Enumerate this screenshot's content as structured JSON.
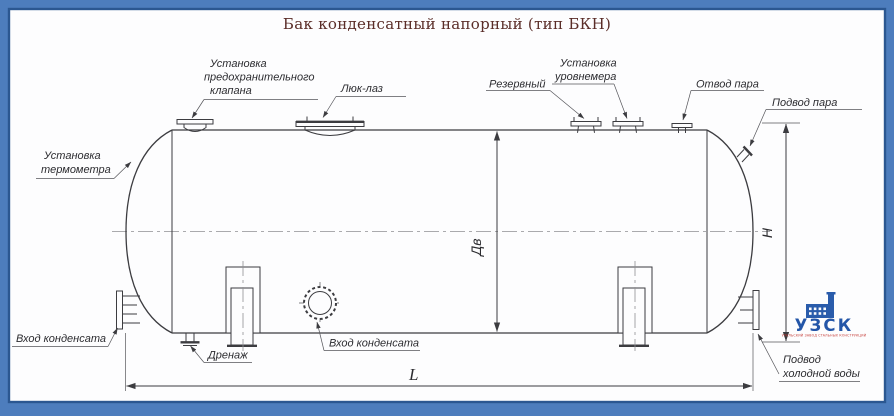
{
  "title": "Бак конденсатный напорный (тип БКН)",
  "drawing": {
    "labels": {
      "thermometer_l1": "Установка",
      "thermometer_l2": "термометра",
      "safety_valve_l1": "Установка",
      "safety_valve_l2": "предохранительного",
      "safety_valve_l3": "клапана",
      "manhole": "Люк-лаз",
      "reserve": "Резервный",
      "level_gauge_l1": "Установка",
      "level_gauge_l2": "уровнемера",
      "steam_outlet": "Отвод пара",
      "steam_inlet": "Подвод пара",
      "condensate_inlet_left": "Вход конденсата",
      "drain": "Дренаж",
      "condensate_inlet_front": "Вход конденсата",
      "cold_water_l1": "Подвод",
      "cold_water_l2": "холодной воды"
    },
    "dimensions": {
      "inner_diameter": "Дв",
      "height": "H",
      "length": "L"
    }
  },
  "logo": {
    "name": "УЗСК",
    "tagline": "УРАЛЬСКИЙ ЗАВОД СТАЛЬНЫХ КОНСТРУКЦИЙ"
  },
  "colors": {
    "frame_outer": "#4d7dbd",
    "frame_inner": "#2b5791",
    "paper": "#fdfdfe",
    "line": "#3c3c40",
    "title_text": "#5a2d28",
    "logo_blue": "#2a5cab",
    "logo_red": "#c43a35"
  }
}
